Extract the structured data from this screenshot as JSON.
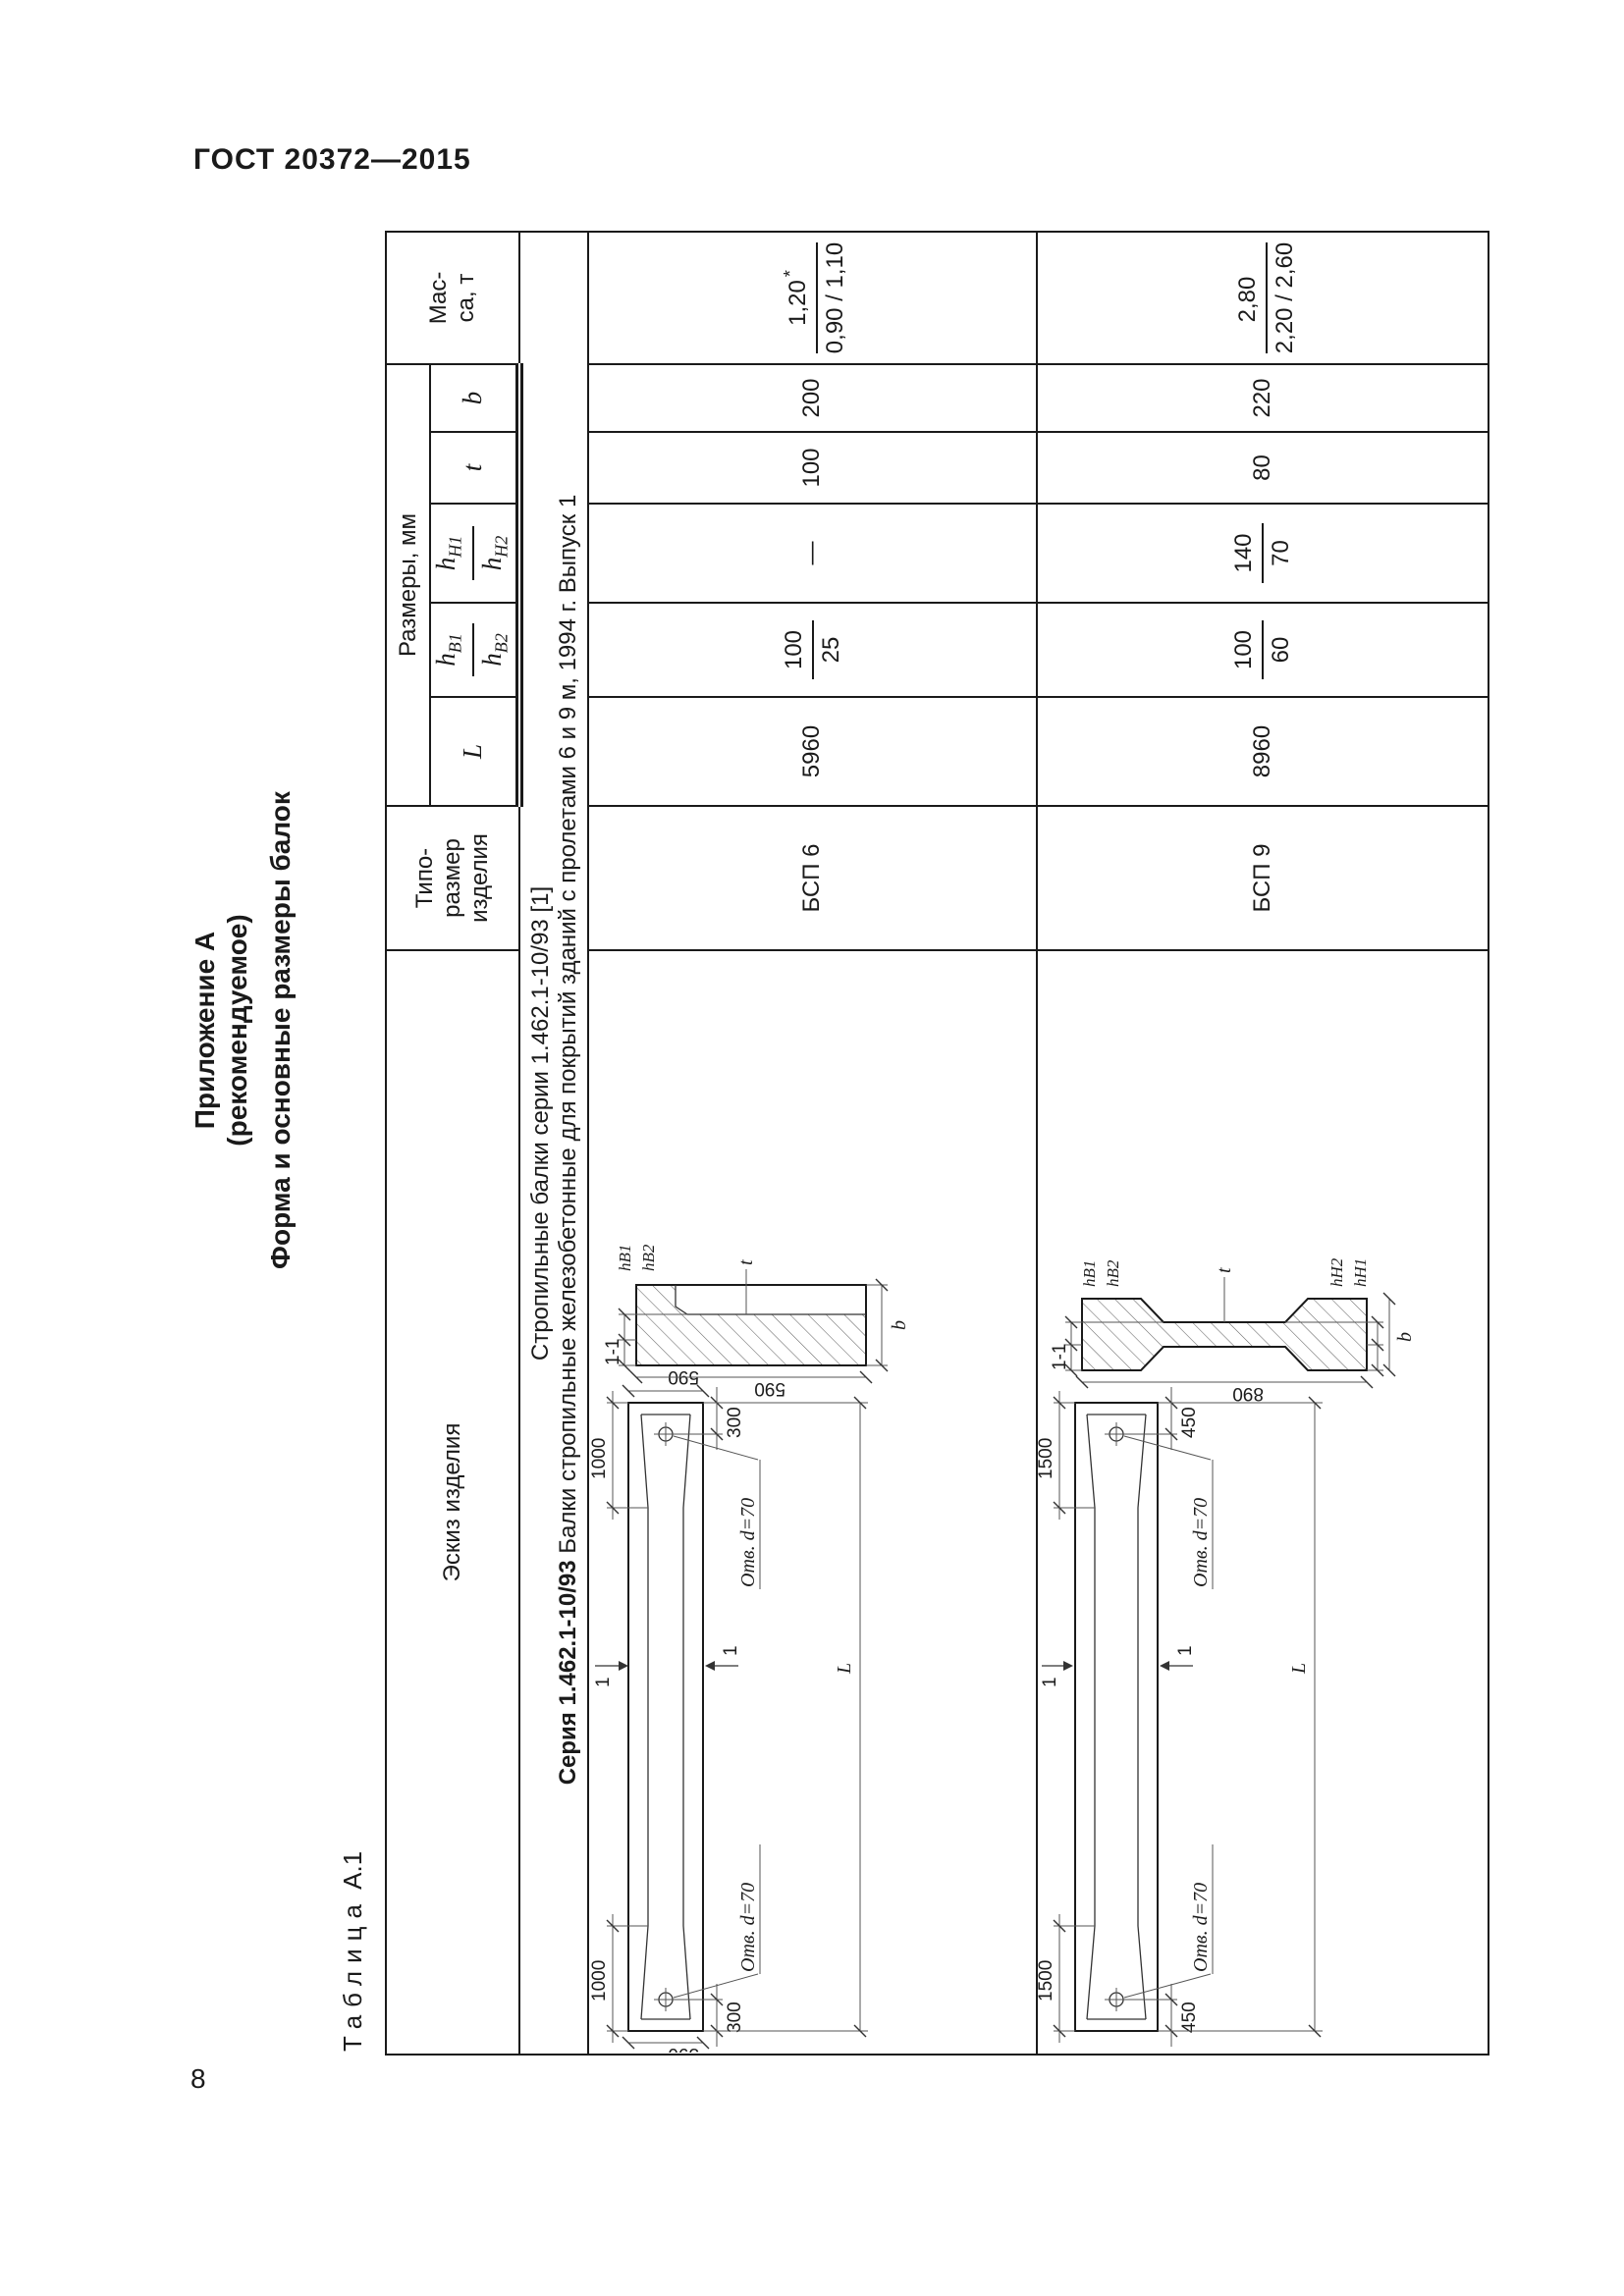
{
  "page": {
    "header": "ГОСТ 20372—2015",
    "number": "8"
  },
  "appendix": {
    "line1": "Приложение А",
    "line2": "(рекомендуемое)",
    "line3": "Форма и основные размеры балок"
  },
  "table_label": {
    "word": "Таблица",
    "id": "А.1"
  },
  "table": {
    "headers": {
      "sketch": "Эскиз изделия",
      "type_size": "Типо-\nразмер\nизделия",
      "dimensions_group": "Размеры, мм",
      "L": "L",
      "hB": {
        "base": "h",
        "num_sub": "В1",
        "den_sub": "В2"
      },
      "hH": {
        "base": "h",
        "num_sub": "Н1",
        "den_sub": "Н2"
      },
      "t": "t",
      "b": "b",
      "mass": "Мас-\nса, т"
    },
    "section": {
      "line1": "Стропильные балки серии 1.462.1-10/93 [1]",
      "line2_bold": "Серия 1.462.1-10/93",
      "line2_rest": " Балки стропильные железобетонные для покрытий зданий с пролетами 6 и 9 м, 1994 г. Выпуск 1"
    },
    "rows": [
      {
        "type": "БСП 6",
        "L": "5960",
        "hB_num": "100",
        "hB_den": "25",
        "hH": "—",
        "t": "100",
        "b": "200",
        "mass_num": "1,20",
        "mass_star": "*",
        "mass_den": "0,90 / 1,10"
      },
      {
        "type": "БСП 9",
        "L": "8960",
        "hB_num": "100",
        "hB_den": "60",
        "hH_num": "140",
        "hH_den": "70",
        "t": "80",
        "b": "220",
        "mass_num": "2,80",
        "mass_star": "",
        "mass_den": "2,20 / 2,60"
      }
    ]
  },
  "drawings": {
    "hole_label": "Отв. d=70",
    "cut_label": "1-1",
    "cut_mark": "1",
    "L_label": "L",
    "bsp6": {
      "chamfer": "1000",
      "hole_offset": "300",
      "end_height": "590",
      "section_height": "590",
      "hb1": "hВ1",
      "hb2": "hВ2",
      "t": "t",
      "b": "b"
    },
    "bsp9": {
      "chamfer": "1500",
      "hole_offset": "450",
      "section_height": "890",
      "hb1": "hВ1",
      "hb2": "hВ2",
      "hn1": "hН1",
      "hn2": "hН2",
      "t": "t",
      "b": "b"
    }
  }
}
